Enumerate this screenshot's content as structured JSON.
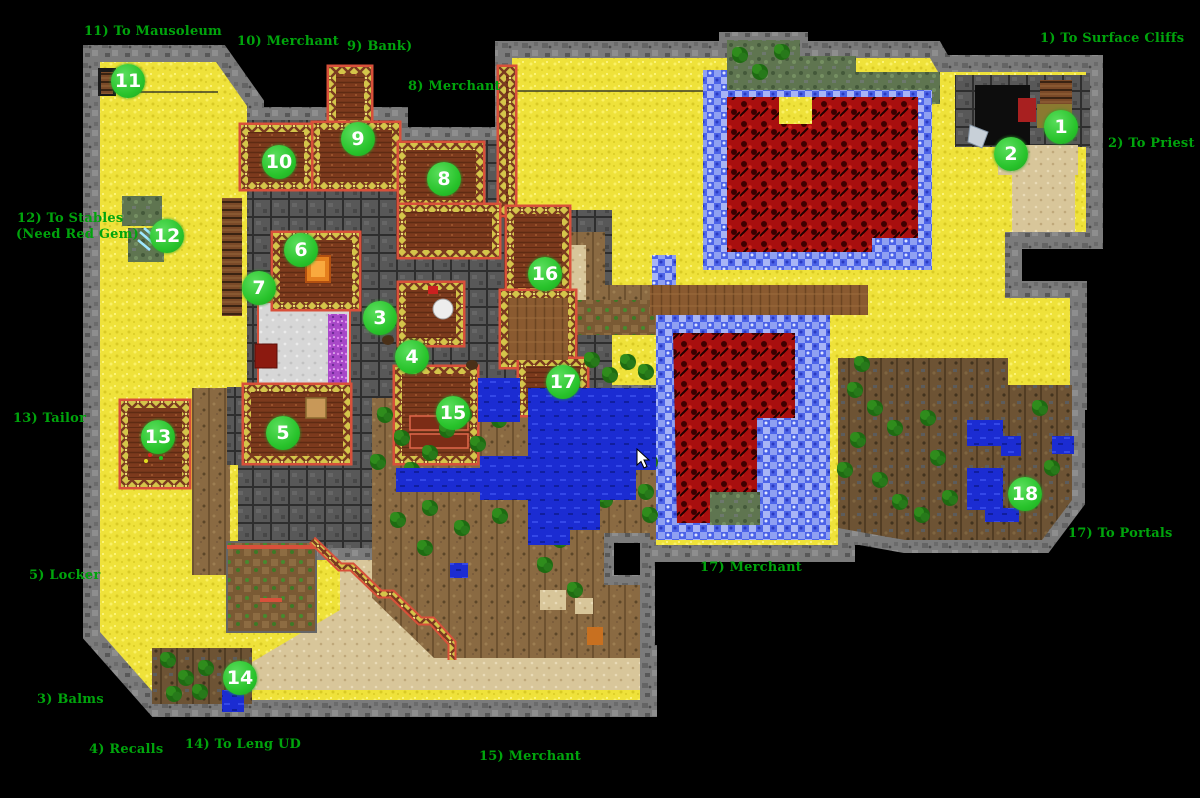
{
  "window": {
    "title": "Leng town map",
    "width": 1200,
    "height": 798
  },
  "colors": {
    "background": "#000000",
    "marker_fill": "#28c32b",
    "marker_text": "#ffffff",
    "label_text": "#00a40c"
  },
  "markers": [
    {
      "n": "1",
      "x": 1061,
      "y": 127
    },
    {
      "n": "2",
      "x": 1011,
      "y": 154
    },
    {
      "n": "3",
      "x": 380,
      "y": 318
    },
    {
      "n": "4",
      "x": 412,
      "y": 357
    },
    {
      "n": "5",
      "x": 283,
      "y": 433
    },
    {
      "n": "6",
      "x": 301,
      "y": 250
    },
    {
      "n": "7",
      "x": 259,
      "y": 288
    },
    {
      "n": "8",
      "x": 444,
      "y": 179
    },
    {
      "n": "9",
      "x": 358,
      "y": 139
    },
    {
      "n": "10",
      "x": 279,
      "y": 162
    },
    {
      "n": "11",
      "x": 128,
      "y": 81
    },
    {
      "n": "12",
      "x": 167,
      "y": 236
    },
    {
      "n": "13",
      "x": 158,
      "y": 437
    },
    {
      "n": "14",
      "x": 240,
      "y": 678
    },
    {
      "n": "15",
      "x": 453,
      "y": 413
    },
    {
      "n": "16",
      "x": 545,
      "y": 274
    },
    {
      "n": "17",
      "x": 563,
      "y": 382
    },
    {
      "n": "18",
      "x": 1025,
      "y": 494
    }
  ],
  "labels": [
    {
      "text": "1) To Surface Cliffs",
      "x": 1040,
      "y": 31
    },
    {
      "text": "2) To Priest",
      "x": 1108,
      "y": 136
    },
    {
      "text": "3) Balms",
      "x": 37,
      "y": 692
    },
    {
      "text": "4) Recalls",
      "x": 89,
      "y": 742
    },
    {
      "text": "5) Locker",
      "x": 29,
      "y": 568
    },
    {
      "text": "8) Merchant",
      "x": 408,
      "y": 79
    },
    {
      "text": "9) Bank)",
      "x": 347,
      "y": 39
    },
    {
      "text": "10) Merchant",
      "x": 237,
      "y": 34
    },
    {
      "text": "11) To Mausoleum",
      "x": 84,
      "y": 24
    },
    {
      "text": "12) To Stables",
      "x": 17,
      "y": 211
    },
    {
      "text": "(Need Red Gem)",
      "x": 16,
      "y": 227
    },
    {
      "text": "13) Tailor",
      "x": 13,
      "y": 411
    },
    {
      "text": "14) To Leng UD",
      "x": 185,
      "y": 737
    },
    {
      "text": "15) Merchant",
      "x": 479,
      "y": 749
    },
    {
      "text": "17) Merchant",
      "x": 700,
      "y": 560
    },
    {
      "text": "17) To Portals",
      "x": 1068,
      "y": 526
    }
  ],
  "cursor": {
    "x": 636,
    "y": 448
  }
}
